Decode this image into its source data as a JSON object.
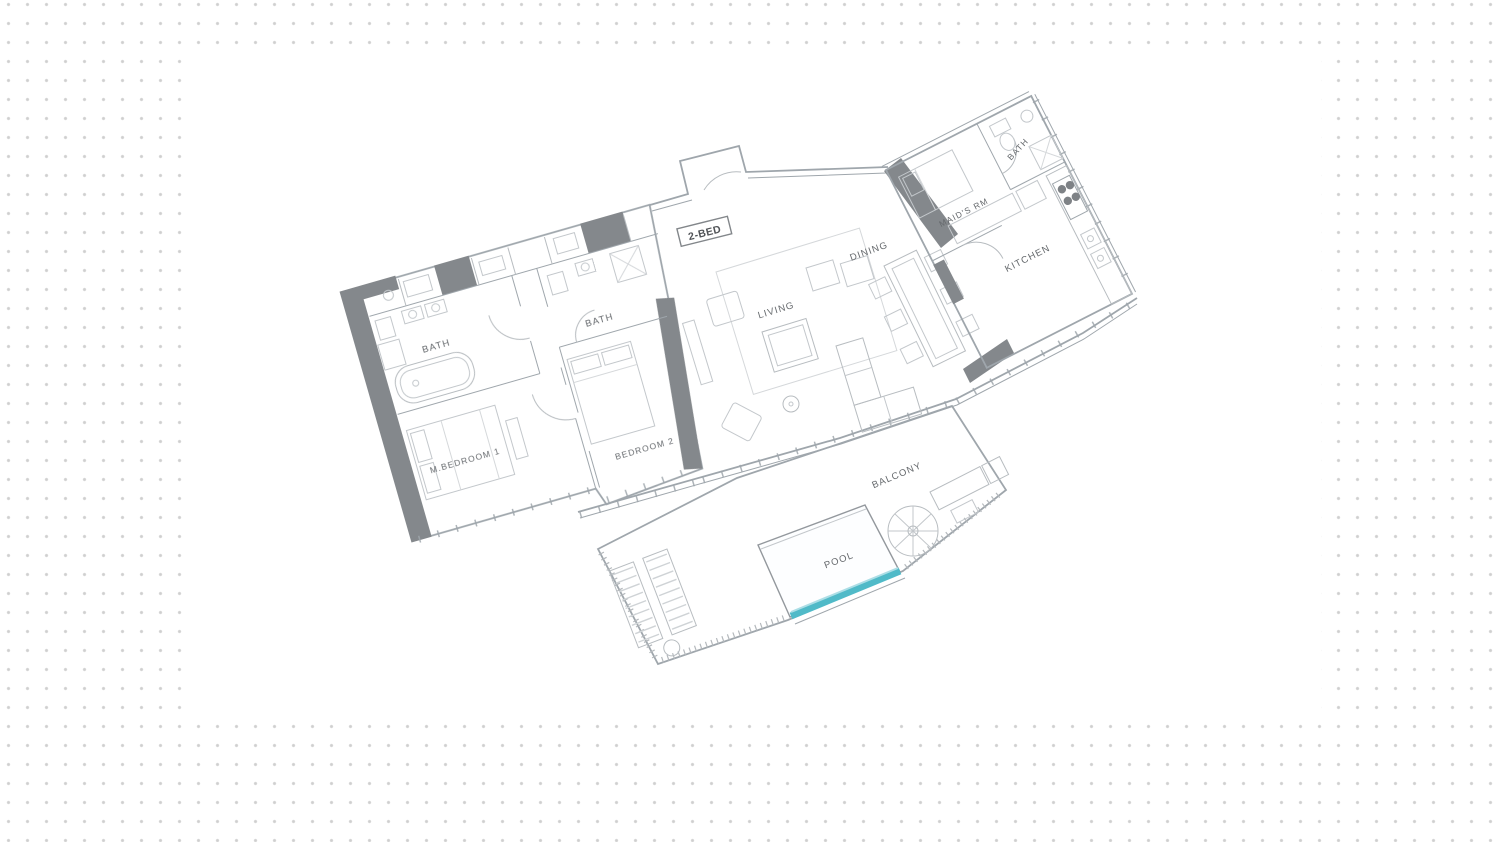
{
  "canvas": {
    "width": 1500,
    "height": 842,
    "dot_grid_color": "#cfcfcf",
    "panel_color": "#ffffff"
  },
  "floorplan": {
    "unit_type_label": "2-BED",
    "colors": {
      "wall": "#9aa2a8",
      "wall_dark": "#7e8286",
      "furniture": "#c0c5c9",
      "label_text": "#5d6165",
      "pool_accent": "#47b7c6"
    },
    "rooms": [
      {
        "id": "master-bath",
        "label": "BATH"
      },
      {
        "id": "bedroom-2-bath",
        "label": "BATH"
      },
      {
        "id": "maids-bath",
        "label": "BATH"
      },
      {
        "id": "master-bedroom",
        "label": "M.BEDROOM 1"
      },
      {
        "id": "bedroom-2",
        "label": "BEDROOM 2"
      },
      {
        "id": "living",
        "label": "LIVING"
      },
      {
        "id": "dining",
        "label": "DINING"
      },
      {
        "id": "kitchen",
        "label": "KITCHEN"
      },
      {
        "id": "maids-room",
        "label": "MAID'S RM"
      },
      {
        "id": "balcony",
        "label": "BALCONY"
      },
      {
        "id": "pool",
        "label": "POOL"
      }
    ]
  }
}
